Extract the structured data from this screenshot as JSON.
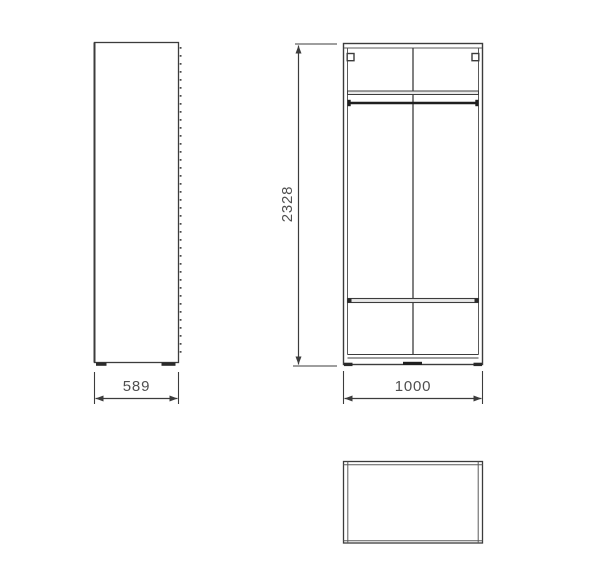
{
  "drawing": {
    "type": "furniture-technical-drawing",
    "subject": "two-door wardrobe orthographic views",
    "dimensions": {
      "height_mm": "2328",
      "width_mm": "1000",
      "depth_mm": "589"
    },
    "colors": {
      "line": "#3c3c3c",
      "line_light": "#9a9a9a",
      "fill_shelf": "#e9e9e9",
      "text": "#4f4f4f",
      "background": "#ffffff"
    }
  }
}
